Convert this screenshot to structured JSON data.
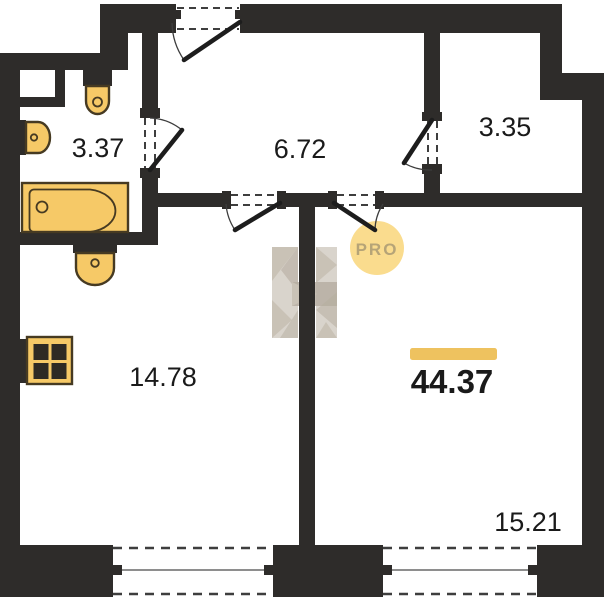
{
  "plan": {
    "type": "apartment-floor-plan",
    "total_area": "44.37",
    "badge": "PRO"
  },
  "rooms": [
    {
      "id": "bathroom",
      "area": "3.37"
    },
    {
      "id": "hallway",
      "area": "6.72"
    },
    {
      "id": "wardrobe",
      "area": "3.35"
    },
    {
      "id": "kitchen-living",
      "area": "14.78"
    },
    {
      "id": "living-room",
      "area": "15.21"
    }
  ],
  "fixtures": [
    "toilet",
    "washbasin",
    "bathtub",
    "kitchen-sink",
    "stove"
  ],
  "openings": [
    "entrance-door",
    "bathroom-door",
    "wardrobe-door",
    "kitchen-door",
    "room-door",
    "kitchen-window",
    "room-window"
  ],
  "colors": {
    "wall": "#2e2c2a",
    "dash": "#3e3e3e",
    "label": "#1a1a1a",
    "fixture": "#f6c967",
    "fixture_outline": "#463a22",
    "accent_bar": "#eec25f",
    "pro_fill": "#fadc8e",
    "pro_text": "#b6a477",
    "watermark_light": "#d8d2ca",
    "watermark_mid": "#c7bfb3",
    "watermark_dark": "#b2a99b"
  }
}
